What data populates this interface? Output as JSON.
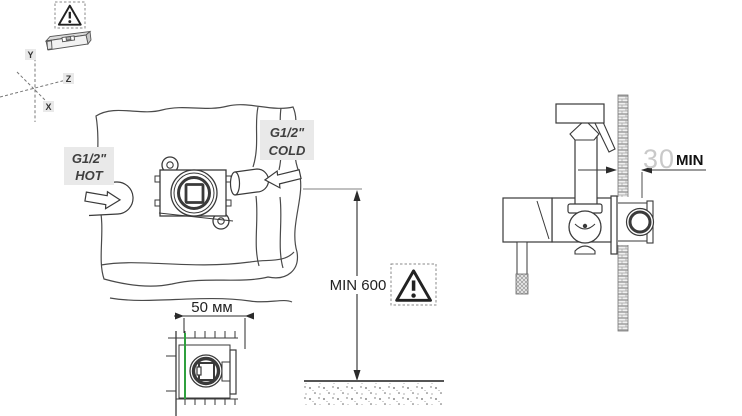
{
  "colors": {
    "line": "#3a3a3a",
    "label_bg": "#e9e9e9",
    "finished_wall_green": "#2fa03e",
    "dim_value_gray": "#c9c9c9"
  },
  "axis": {
    "y": "Y",
    "z": "Z",
    "x": "X"
  },
  "supply": {
    "hot": {
      "thread": "G1/2\"",
      "label": "HOT"
    },
    "cold": {
      "thread": "G1/2\"",
      "label": "COLD"
    }
  },
  "dimensions": {
    "valve_depth": "50 мм",
    "height_above_floor": "MIN 600",
    "wall_thickness_min": "30",
    "wall_thickness_suffix": "MIN"
  }
}
